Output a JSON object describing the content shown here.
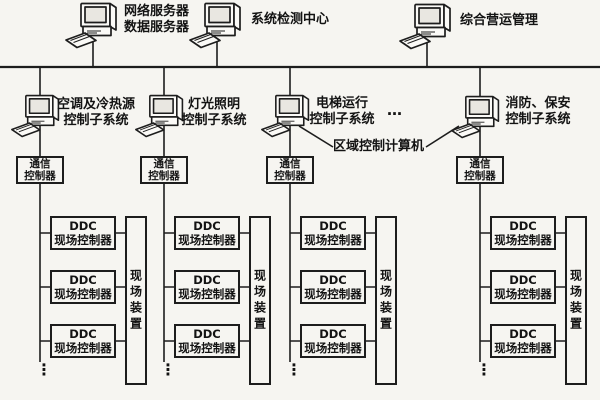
{
  "colors": {
    "background": "#f6f5f1",
    "line": "#1d1d1d",
    "text": "#131313",
    "icon_fill": "#fbfaf7",
    "screen_fill": "#e9e7e1"
  },
  "top_row": {
    "stations": [
      {
        "line1": "网络服务器",
        "line2": "数据服务器"
      },
      {
        "line1": "系统检测中心"
      },
      {
        "line1": "综合营运管理"
      }
    ]
  },
  "middle_row": {
    "subsystems": [
      {
        "line1": "空调及冷热源",
        "line2": "控制子系统"
      },
      {
        "line1": "灯光照明",
        "line2": "控制子系统"
      },
      {
        "line1": "电梯运行",
        "line2": "控制子系统"
      },
      {
        "line1": "消防、保安",
        "line2": "控制子系统"
      }
    ],
    "ellipsis": "…",
    "regional_computer_label": "区域控制计算机"
  },
  "comm_controller": {
    "line1": "通信",
    "line2": "控制器"
  },
  "ddc_controller": {
    "line1": "DDC",
    "line2": "现场控制器"
  },
  "field_device_label": "现场装置",
  "column_ellipsis": "⋮"
}
